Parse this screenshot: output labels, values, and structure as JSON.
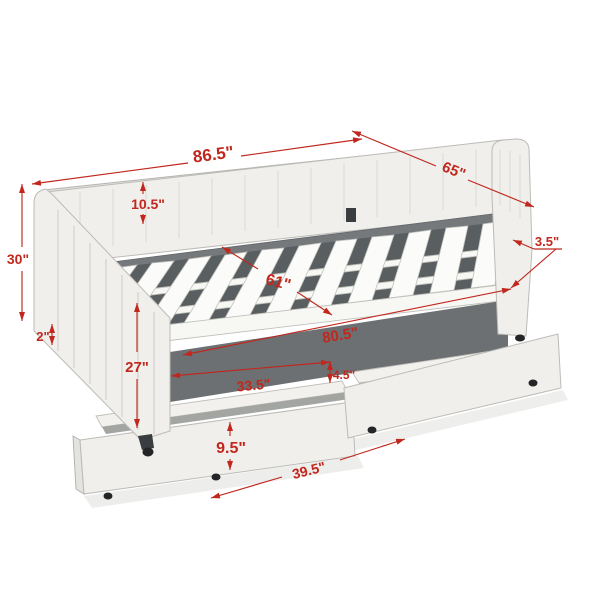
{
  "diagram": {
    "kind": "furniture-dimension-diagram",
    "subject": "Upholstered daybed with channel tufting, wooden slats and two pull-out storage drawers",
    "background_color": "#ffffff",
    "accent_color": "#c1271d",
    "bed_colors": {
      "fabric": "#f0efec",
      "inner_board": "#75797c",
      "slat": "#fbfbf9",
      "slat_gap": "#595e61",
      "caster": "#232526"
    },
    "dimensions": {
      "overall_length": "86.5\"",
      "overall_depth": "65\"",
      "overall_height": "30\"",
      "backrest_height": "10.5\"",
      "side_rail_thickness": "3.5\"",
      "slat_area_width": "61\"",
      "bottom_clearance": "2\"",
      "arm_front_height": "27\"",
      "inner_length": "80.5\"",
      "drawer_front_width": "33.5\"",
      "drawer_divider_gap": "4.5\"",
      "drawer_height": "9.5\"",
      "drawer_depth": "39.5\""
    }
  }
}
